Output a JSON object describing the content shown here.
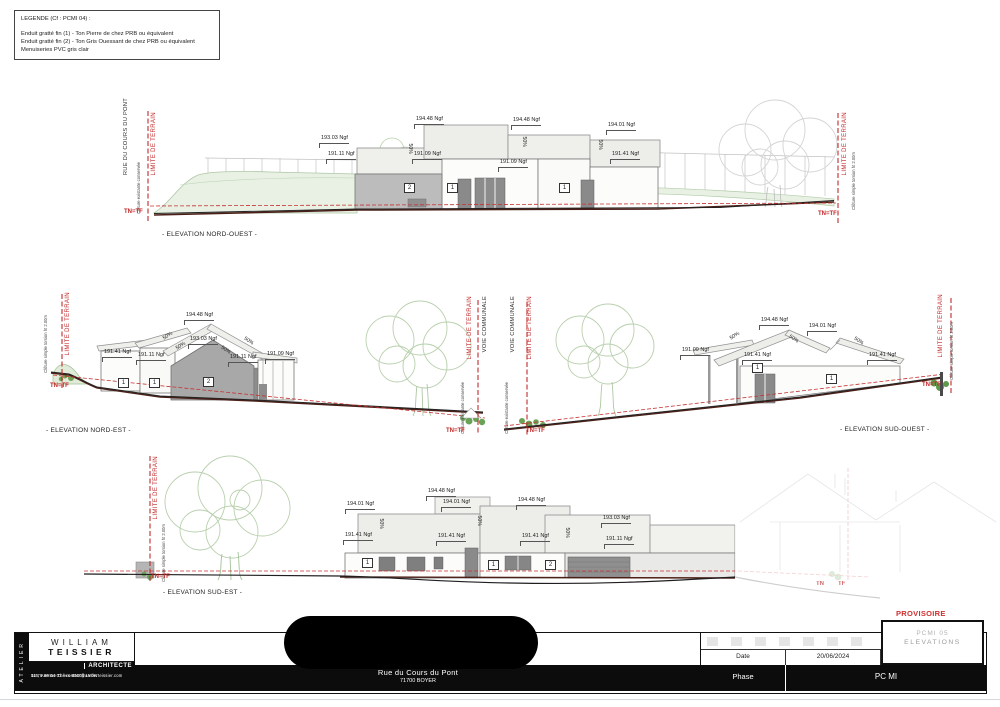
{
  "legend": {
    "title": "LEGENDE (Cf : PCMI 04) :",
    "lines": [
      "Enduit gratté fin (1) - Ton Pierre de chez PRB ou équivalent",
      "Enduit gratté fin (2) - Ton Gris Ouessant de chez PRB ou équivalent",
      "Menuiseries PVC gris clair"
    ]
  },
  "titleblock": {
    "atelier": "ATELIER",
    "name_line1": "WILLIAM",
    "name_line2": "TEISSIER",
    "role": "ARCHITECTE",
    "address1": "115,  Avenue  Thiers  69006  LYON",
    "address2": "04 78 89 04 02 / contact@atelierteissier.com",
    "project_address1": "Rue du Cours du Pont",
    "project_address2": "71700 BOYER",
    "date_label": "Date",
    "date_value": "20/06/2024",
    "phase_label": "Phase",
    "phase_value": "PC MI",
    "sheet_ref_ghost": "PCMI 05",
    "sheet_title": "ELEVATIONS"
  },
  "annotations": [
    {
      "t": "RUE DU COURS DU PONT",
      "x": 123,
      "y": 98,
      "cls": "vlab-black"
    },
    {
      "t": "LIMITE DE TERRAIN",
      "x": 151,
      "y": 112,
      "cls": "vlab-red"
    },
    {
      "t": "Clôture existante conservée",
      "x": 137,
      "y": 162,
      "cls": "vlab-tiny"
    },
    {
      "t": "TN=TF",
      "x": 124,
      "y": 209,
      "cls": "tnlab"
    },
    {
      "t": "LIMITE DE TERRAIN",
      "x": 842,
      "y": 112,
      "cls": "vlab-red"
    },
    {
      "t": "Clôture simple torsion ht 2.00m",
      "x": 852,
      "y": 152,
      "cls": "vlab-tiny"
    },
    {
      "t": "TN=TF",
      "x": 818,
      "y": 211,
      "cls": "tnlab"
    },
    {
      "t": "- ELEVATION NORD-OUEST -",
      "x": 162,
      "y": 232,
      "cls": "caption"
    },
    {
      "t": "194.48 Ngf",
      "x": 415,
      "y": 117,
      "cls": "dim"
    },
    {
      "t": "194.48 Ngf",
      "x": 512,
      "y": 118,
      "cls": "dim"
    },
    {
      "t": "194.01 Ngf",
      "x": 607,
      "y": 123,
      "cls": "dim"
    },
    {
      "t": "193.03 Ngf",
      "x": 320,
      "y": 136,
      "cls": "dim"
    },
    {
      "t": "191.11 Ngf",
      "x": 327,
      "y": 152,
      "cls": "dim"
    },
    {
      "t": "191.09 Ngf",
      "x": 413,
      "y": 152,
      "cls": "dim"
    },
    {
      "t": "191.09 Ngf",
      "x": 499,
      "y": 160,
      "cls": "dim"
    },
    {
      "t": "191.41 Ngf",
      "x": 611,
      "y": 152,
      "cls": "dim"
    },
    {
      "t": "50%",
      "x": 404,
      "y": 146,
      "cls": "slope",
      "r": 90
    },
    {
      "t": "50%",
      "x": 518,
      "y": 139,
      "cls": "slope",
      "r": 90
    },
    {
      "t": "50%",
      "x": 594,
      "y": 142,
      "cls": "slope",
      "r": 90
    },
    {
      "t": "2",
      "x": 404,
      "y": 183,
      "cls": "typebox"
    },
    {
      "t": "1",
      "x": 447,
      "y": 183,
      "cls": "typebox"
    },
    {
      "t": "1",
      "x": 559,
      "y": 183,
      "cls": "typebox"
    },
    {
      "t": "LIMITE DE TERRAIN",
      "x": 65,
      "y": 292,
      "cls": "vlab-red"
    },
    {
      "t": "Clôture simple torsion ht 2.00m",
      "x": 44,
      "y": 315,
      "cls": "vlab-tiny"
    },
    {
      "t": "TN=TF",
      "x": 50,
      "y": 383,
      "cls": "tnlab"
    },
    {
      "t": "- ELEVATION NORD-EST -",
      "x": 46,
      "y": 428,
      "cls": "caption"
    },
    {
      "t": "194.48 Ngf",
      "x": 185,
      "y": 313,
      "cls": "dim"
    },
    {
      "t": "193.03 Ngf",
      "x": 189,
      "y": 337,
      "cls": "dim"
    },
    {
      "t": "191.41 Ngf",
      "x": 103,
      "y": 350,
      "cls": "dim"
    },
    {
      "t": "191.11 Ngf",
      "x": 137,
      "y": 353,
      "cls": "dim"
    },
    {
      "t": "191.11 Ngf",
      "x": 229,
      "y": 355,
      "cls": "dim"
    },
    {
      "t": "191.09 Ngf",
      "x": 266,
      "y": 352,
      "cls": "dim"
    },
    {
      "t": "50%",
      "x": 163,
      "y": 334,
      "cls": "slope",
      "r": -33
    },
    {
      "t": "50%",
      "x": 176,
      "y": 344,
      "cls": "slope",
      "r": -33
    },
    {
      "t": "50%",
      "x": 220,
      "y": 348,
      "cls": "slope",
      "r": 33
    },
    {
      "t": "50%",
      "x": 243,
      "y": 339,
      "cls": "slope",
      "r": 33
    },
    {
      "t": "1",
      "x": 118,
      "y": 378,
      "cls": "typebox"
    },
    {
      "t": "1",
      "x": 149,
      "y": 378,
      "cls": "typebox"
    },
    {
      "t": "2",
      "x": 203,
      "y": 377,
      "cls": "typebox"
    },
    {
      "t": "LIMITE DE TERRAIN",
      "x": 467,
      "y": 296,
      "cls": "vlab-red"
    },
    {
      "t": "VOIE COMMUNALE",
      "x": 482,
      "y": 296,
      "cls": "vlab-black"
    },
    {
      "t": "Clôture existante conservée",
      "x": 461,
      "y": 382,
      "cls": "vlab-tiny"
    },
    {
      "t": "TN=TF",
      "x": 446,
      "y": 428,
      "cls": "tnlab"
    },
    {
      "t": "VOIE COMMUNALE",
      "x": 510,
      "y": 296,
      "cls": "vlab-black"
    },
    {
      "t": "LIMITE DE TERRAIN",
      "x": 527,
      "y": 296,
      "cls": "vlab-red"
    },
    {
      "t": "Clôture existante conservée",
      "x": 505,
      "y": 382,
      "cls": "vlab-tiny"
    },
    {
      "t": "TN=TF",
      "x": 526,
      "y": 428,
      "cls": "tnlab"
    },
    {
      "t": "194.48 Ngf",
      "x": 760,
      "y": 318,
      "cls": "dim"
    },
    {
      "t": "194.01 Ngf",
      "x": 808,
      "y": 324,
      "cls": "dim"
    },
    {
      "t": "191.09 Ngf",
      "x": 681,
      "y": 348,
      "cls": "dim"
    },
    {
      "t": "191.41 Ngf",
      "x": 743,
      "y": 353,
      "cls": "dim"
    },
    {
      "t": "191.41 Ngf",
      "x": 868,
      "y": 353,
      "cls": "dim"
    },
    {
      "t": "50%",
      "x": 730,
      "y": 334,
      "cls": "slope",
      "r": -33
    },
    {
      "t": "50%",
      "x": 788,
      "y": 337,
      "cls": "slope",
      "r": 33
    },
    {
      "t": "50%",
      "x": 853,
      "y": 339,
      "cls": "slope",
      "r": 33
    },
    {
      "t": "1",
      "x": 752,
      "y": 363,
      "cls": "typebox"
    },
    {
      "t": "1",
      "x": 826,
      "y": 374,
      "cls": "typebox"
    },
    {
      "t": "LIMITE DE TERRAIN",
      "x": 938,
      "y": 294,
      "cls": "vlab-red"
    },
    {
      "t": "Clôture simple torsion ht 2.00m",
      "x": 950,
      "y": 322,
      "cls": "vlab-tiny"
    },
    {
      "t": "TN=TF",
      "x": 922,
      "y": 382,
      "cls": "tnlab"
    },
    {
      "t": "- ELEVATION SUD-OUEST -",
      "x": 840,
      "y": 427,
      "cls": "caption"
    },
    {
      "t": "LIMITE DE TERRAIN",
      "x": 153,
      "y": 456,
      "cls": "vlab-red"
    },
    {
      "t": "Clôture simple torsion ht 2.00m",
      "x": 162,
      "y": 524,
      "cls": "vlab-tiny"
    },
    {
      "t": "TN=TF",
      "x": 151,
      "y": 574,
      "cls": "tnlab"
    },
    {
      "t": "- ELEVATION SUD-EST -",
      "x": 163,
      "y": 590,
      "cls": "caption"
    },
    {
      "t": "194.01 Ngf",
      "x": 346,
      "y": 502,
      "cls": "dim"
    },
    {
      "t": "191.41 Ngf",
      "x": 344,
      "y": 533,
      "cls": "dim"
    },
    {
      "t": "50%",
      "x": 375,
      "y": 521,
      "cls": "slope",
      "r": 90
    },
    {
      "t": "194.48 Ngf",
      "x": 427,
      "y": 489,
      "cls": "dim"
    },
    {
      "t": "194.01 Ngf",
      "x": 442,
      "y": 500,
      "cls": "dim"
    },
    {
      "t": "194.48 Ngf",
      "x": 517,
      "y": 498,
      "cls": "dim"
    },
    {
      "t": "193.03 Ngf",
      "x": 602,
      "y": 516,
      "cls": "dim"
    },
    {
      "t": "191.41 Ngf",
      "x": 437,
      "y": 534,
      "cls": "dim"
    },
    {
      "t": "191.41 Ngf",
      "x": 521,
      "y": 534,
      "cls": "dim"
    },
    {
      "t": "191.11 Ngf",
      "x": 605,
      "y": 537,
      "cls": "dim"
    },
    {
      "t": "50%",
      "x": 473,
      "y": 518,
      "cls": "slope",
      "r": 90
    },
    {
      "t": "50%",
      "x": 561,
      "y": 530,
      "cls": "slope",
      "r": 90
    },
    {
      "t": "1",
      "x": 362,
      "y": 558,
      "cls": "typebox"
    },
    {
      "t": "1",
      "x": 488,
      "y": 560,
      "cls": "typebox"
    },
    {
      "t": "2",
      "x": 545,
      "y": 560,
      "cls": "typebox"
    },
    {
      "t": "TN",
      "x": 816,
      "y": 581,
      "cls": "tnlab-faint"
    },
    {
      "t": "TF",
      "x": 838,
      "y": 581,
      "cls": "tnlab-faint"
    },
    {
      "t": "PROVISOIRE",
      "x": 896,
      "y": 610,
      "cls": "provisoire"
    }
  ]
}
